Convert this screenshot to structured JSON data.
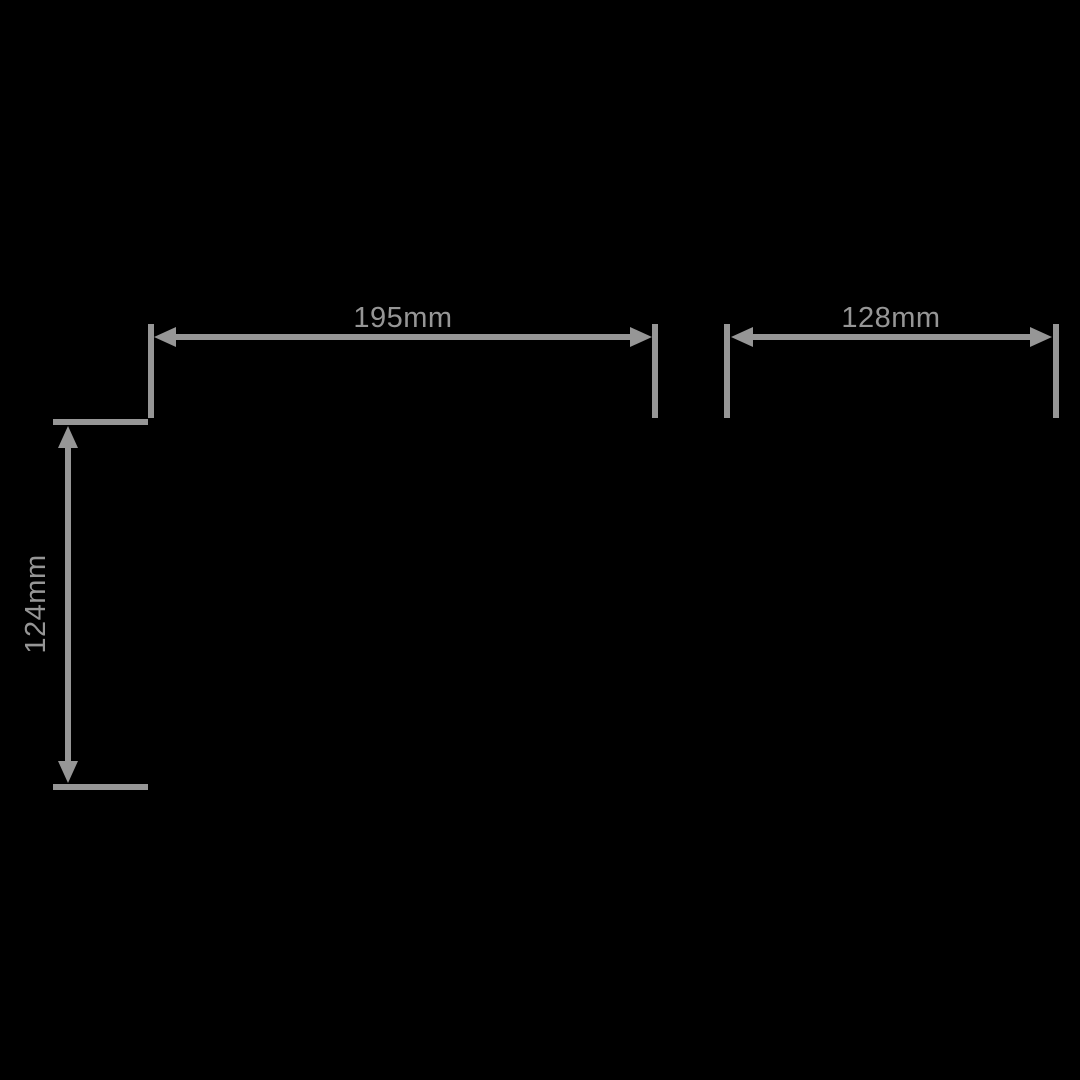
{
  "drawing": {
    "type": "technical-dimension-drawing",
    "background_color": "#000000",
    "line_color": "#969696",
    "text_color": "#969696",
    "dimensions": {
      "top_left_width": {
        "label": "195mm",
        "value_mm": 195,
        "orientation": "horizontal"
      },
      "top_right_width": {
        "label": "128mm",
        "value_mm": 128,
        "orientation": "horizontal"
      },
      "left_height": {
        "label": "124mm",
        "value_mm": 124,
        "orientation": "vertical"
      }
    }
  }
}
